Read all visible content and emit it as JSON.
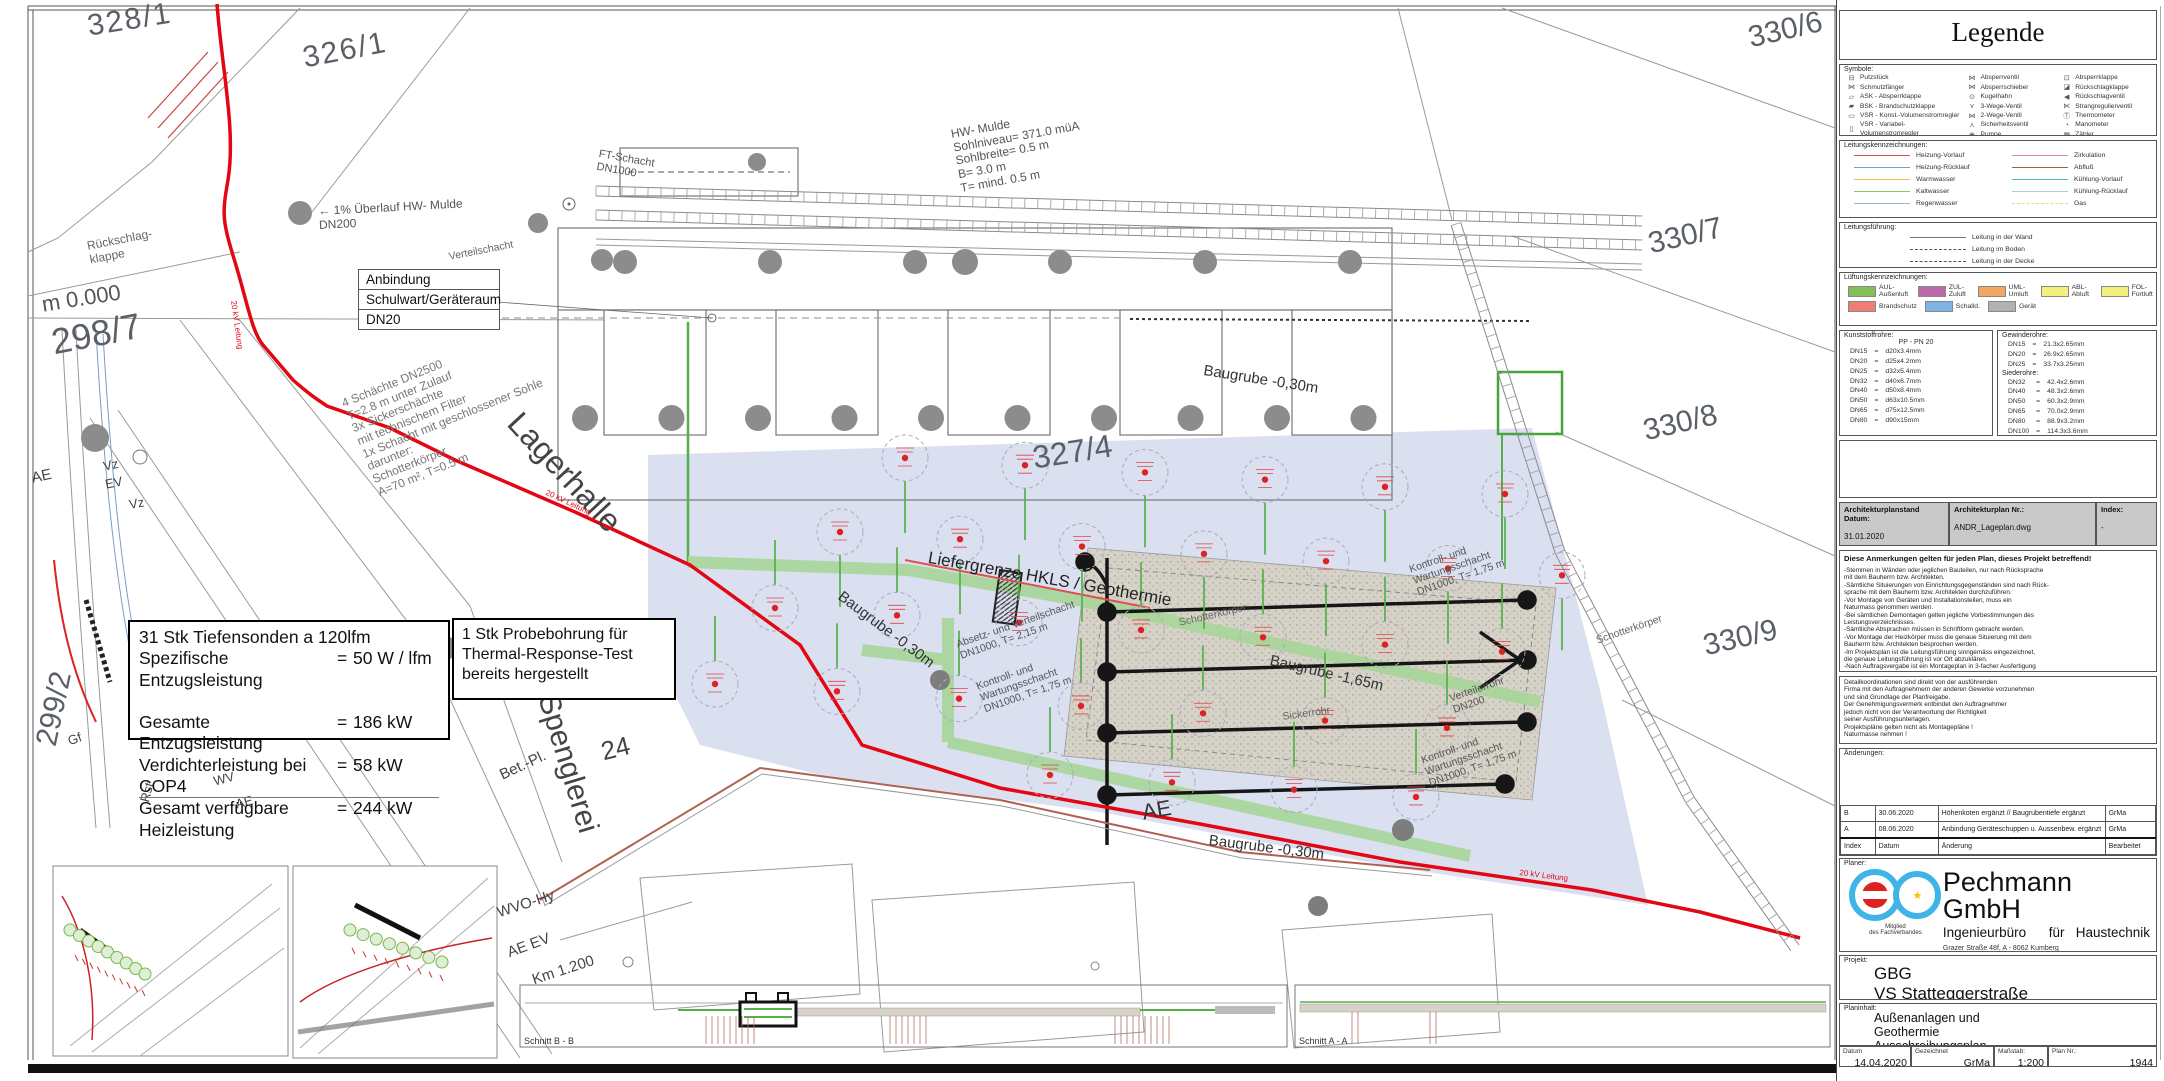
{
  "colors": {
    "red_20kv": "#e30613",
    "green_pipe": "#a9d69b",
    "green_line": "#55b04a",
    "blue_zone": "#ccd3ea",
    "gravel": "#d6d2c8",
    "black_pipe": "#161616"
  },
  "legend": {
    "title": "Legende",
    "symbole_label": "Symbole:",
    "sym_col1": [
      {
        "g": "⊟",
        "label": "Putzstück"
      },
      {
        "g": "⋈",
        "label": "Schmutzfänger"
      },
      {
        "g": "▱",
        "label": "ASK  - Absperrklappe"
      },
      {
        "g": "▰",
        "label": "BSK  - Brandschutzklappe"
      },
      {
        "g": "▭",
        "label": "VSR  - Konst.-Volumenstromregler"
      },
      {
        "g": "▯",
        "label": "VSR  - Variabel-Volumenstromregler"
      }
    ],
    "sym_col2": [
      {
        "g": "⋈",
        "label": "Absperrventil"
      },
      {
        "g": "⋈",
        "label": "Absperrschieber"
      },
      {
        "g": "⊙",
        "label": "Kugelhahn"
      },
      {
        "g": "⋎",
        "label": "3-Wege-Ventil"
      },
      {
        "g": "⋈",
        "label": "2-Wege-Ventil"
      },
      {
        "g": "⋏",
        "label": "Sicherheitsventil"
      },
      {
        "g": "◉",
        "label": "Pumpe"
      }
    ],
    "sym_col3": [
      {
        "g": "⊡",
        "label": "Absperrklappe"
      },
      {
        "g": "◪",
        "label": "Rückschlagklappe"
      },
      {
        "g": "◀",
        "label": "Rückschlagventil"
      },
      {
        "g": "⋉",
        "label": "Strangregulierventil"
      },
      {
        "g": "Ⓣ",
        "label": "Thermometer"
      },
      {
        "g": "◔",
        "label": "Manometer"
      },
      {
        "g": "▦",
        "label": "Zähler"
      }
    ],
    "leitungs_label": "Leitungskennzeichnungen:",
    "leitungen_left": [
      {
        "label": "Heizung-Vorlauf",
        "color": "#d9534f",
        "dash": false
      },
      {
        "label": "Heizung-Rücklauf",
        "color": "#7b9cc4",
        "dash": false
      },
      {
        "label": "Warmwasser",
        "color": "#e8c14d",
        "dash": false
      },
      {
        "label": "Kaltwasser",
        "color": "#8fc470",
        "dash": false
      },
      {
        "label": "Regenwasser",
        "color": "#9ab7d6",
        "dash": false
      }
    ],
    "leitungen_right": [
      {
        "label": "Zirkulation",
        "color": "#e08a8a",
        "dash": false
      },
      {
        "label": "Abfluß",
        "color": "#a65b43",
        "dash": false
      },
      {
        "label": "Kühlung-Vorlauf",
        "color": "#4db6c4",
        "dash": false
      },
      {
        "label": "Kühlung-Rücklauf",
        "color": "#a3d0da",
        "dash": false
      },
      {
        "label": "Gas",
        "color": "#e3de77",
        "dash": true
      }
    ],
    "fuehrung_label": "Leitungsführung:",
    "fuehrung": [
      {
        "label": "Leitung in der Wand",
        "style": "solid"
      },
      {
        "label": "Leitung im Boden",
        "style": "dashed"
      },
      {
        "label": "Leitung in der Decke",
        "style": "dashed"
      }
    ],
    "lueftung_label": "Lüftungskennzeichnungen:",
    "lueftung_row1": [
      {
        "label": "AUL-Außenluft",
        "color": "#84bf5a"
      },
      {
        "label": "ZUL-Zuluft",
        "color": "#bc6aab"
      },
      {
        "label": "UML-Umluft",
        "color": "#f2a65e"
      },
      {
        "label": "ABL-Abluft",
        "color": "#f4f07e"
      },
      {
        "label": "FOL-Fortluft",
        "color": "#f4f07e"
      }
    ],
    "lueftung_row2": [
      {
        "label": "Brandschutz",
        "color": "#ef7d72"
      },
      {
        "label": "Schalld.",
        "color": "#7fb2e5"
      },
      {
        "label": "Gerät",
        "color": "#b2b2b2"
      }
    ],
    "kunststoff_label": "Kunststoffrohre:",
    "kunststoff_header": "PP  -  PN 20",
    "kunststoff_rows": [
      [
        "DN15",
        "=",
        "d20x3.4mm"
      ],
      [
        "DN20",
        "=",
        "d25x4.2mm"
      ],
      [
        "DN25",
        "=",
        "d32x5.4mm"
      ],
      [
        "DN32",
        "=",
        "d40x6.7mm"
      ],
      [
        "DN40",
        "=",
        "d50x8.4mm"
      ],
      [
        "DN50",
        "=",
        "d63x10.5mm"
      ],
      [
        "DN65",
        "=",
        "d75x12.5mm"
      ],
      [
        "DN80",
        "=",
        "d90x15mm"
      ]
    ],
    "gewinde_label": "Gewinderohre:",
    "gewinde_rows": [
      [
        "DN15",
        "=",
        "21.3x2.65mm"
      ],
      [
        "DN20",
        "=",
        "26.9x2.65mm"
      ],
      [
        "DN25",
        "=",
        "33.7x3.25mm"
      ]
    ],
    "siede_label": "Siederohre:",
    "siede_rows": [
      [
        "DN32",
        "=",
        "42.4x2.6mm"
      ],
      [
        "DN40",
        "=",
        "48.3x2.6mm"
      ],
      [
        "DN50",
        "=",
        "60.3x2.9mm"
      ],
      [
        "DN65",
        "=",
        "70.0x2.9mm"
      ],
      [
        "DN80",
        "=",
        "88.9x3.2mm"
      ],
      [
        "DN100",
        "=",
        "114.3x3.6mm"
      ]
    ]
  },
  "plan_meta": {
    "stand_label": "Architekturplanstand Datum:",
    "stand": "31.01.2020",
    "nr_label": "Architekturplan Nr.:",
    "nr": "ANDR_Lageplan.dwg",
    "index_label": "Index:",
    "index": "-"
  },
  "notes": {
    "heading": "Diese Anmerkungen gelten für jeden Plan, dieses Projekt betreffend!",
    "body": "-Stemmen in Wänden oder jeglichen Bauteilen, nur nach Rücksprache\n mit dem Bauherrn bzw. Architekten.\n-Sämtliche Situierungen von Einrichtungsgegenständen sind nach Rück-\n sprache mit dem Bauherrn bzw. Architekten durchzuführen.\n-Vor Montage von Geräten und Installationsteilen, muss ein\n Naturmass genommen werden.\n-Bei sämtlichen Demontagen gelten jegliche Vorbestimmungen des\n Leistungsverzeichnisses.\n-Sämtliche Absprachen müssen in Schriftform gebracht werden.\n-Vor Montage der Heizkörper muss die genaue Situierung mit dem\n Bauherrn bzw. Architekten besprochen werden.\n-Im Projektsplan ist die Leitungsführung sinngemäss eingezeichnet,\n die genaue Leitungsführung ist vor Ort abzuklären.\n-Nach Auftragsvergabe ist ein Montageplan in 3-facher Ausfertigung\n zu zeichnen und dem Technischen Büro zur Freigabe vorzulegen."
  },
  "detail_note": "Detailkoordinationen sind direkt von der ausführenden\nFirma mit den Auftragnehmern der anderen Gewerke vorzunehmen\nund sind Grundlage der Planfreigabe.\nDer Genehmigungsvermerk entbindet den Auftragnehmer\njedoch nicht von der Verantwortung der Richtigkeit\nseiner Ausführungsunterlagen.\nProjektspläne gelten nicht als Montagepläne !\nNaturmasse nehmen !",
  "changes": {
    "label": "Änderungen:",
    "rows": [
      [
        "B",
        "30.06.2020",
        "Höhenkoten ergänzt // Baugrubentiefe ergänzt",
        "GrMa"
      ],
      [
        "A",
        "08.06.2020",
        "Anbindung Geräteschuppen u. Aussenbew. ergänzt",
        "GrMa"
      ],
      [
        "Index",
        "Datum",
        "Änderung",
        "Bearbeitet"
      ]
    ]
  },
  "planer": {
    "label": "Planer:",
    "company": "Pechmann GmbH",
    "subtitle": "Ingenieurbüro      für   Haustechnik",
    "address": "Grazer Straße 48f, A - 8062 Kumberg\nTel.: 03132/5485 Fax: 03132/5485-16\ne-mail: office@tb-pechmann.at",
    "member": "Mitglied\ndes Fachverbandes"
  },
  "projekt": {
    "label": "Projekt:",
    "text": "GBG\nVS Statteggerstraße"
  },
  "planinhalt": {
    "label": "Planinhalt:",
    "text": "Außenanlagen und\nGeothermie\nAusschreibungsplan"
  },
  "footer": {
    "datum_label": "Datum",
    "datum": "14.04.2020",
    "gez_label": "Gezeichnet",
    "gez": "GrMa",
    "mass_label": "Maßstab:",
    "mass": "1:200",
    "plan_label": "Plan Nr.:",
    "plan": "1944"
  },
  "map": {
    "parcels": {
      "p328_1": "328/1",
      "p326_1": "326/1",
      "p330_6": "330/6",
      "p330_7": "330/7",
      "p330_8": "330/8",
      "p330_9": "330/9",
      "p327_4": "327/4",
      "p298_7": "298/7",
      "p299_2": "299/2"
    },
    "labels": {
      "lagerhalle": "Lagerhalle",
      "spenglerei": "Spenglerei",
      "nr24": "24",
      "betpl": "Bet.-Pl.",
      "wvohy": "WVO-Hy",
      "aeev": "AE EV",
      "km": "Km 1.200",
      "m0": "m 0.000",
      "ae": "AE",
      "vz": "Vz",
      "ev": "EV",
      "gf": "Gf",
      "rst": "Rst",
      "wv": "WV",
      "rueckschlag": "Rückschlag-\nklappe",
      "hw_mulde": "HW- Mulde\nSohlniveau= 371.0 müA\nSohlbreite= 0.5 m\nB= 3.0 m\nT= mind. 0.5 m",
      "ueberlauf": "← 1% Überlauf HW- Mulde\n         DN200",
      "ft_schacht": "FT-Schacht\nDN1000",
      "schaechte": "4 Schächte DN2500\nT=2.8 m unter Zulauf\n3x Sickerschächte\nmit technischem Filter\n1x Schacht mit geschlossener Sohle\ndarunter:\nSchotterkörper\nA=70 m², T=0.5 m",
      "liefergrenze": "Liefergrenze HKLS / Geothermie",
      "baugrube30": "Baugrube -0,30m",
      "baugrube165": "Baugrube -1,65m",
      "absetz": "Absetz- und Verteilschacht\nDN1000, T= 2,15 m",
      "kontroll": "Kontroll- und\nWartungsschacht\nDN1000, T= 1,75 m",
      "verteilerrohr": "Verteilerrohr\nDN200",
      "schotter": "Schotterkörper",
      "sickerrohr": "Sickerrohr",
      "verteilschacht": "Verteilschacht",
      "kv": "20 kV Leitung",
      "schnitt_b": "Schnitt B - B",
      "schnitt_a": "Schnitt A - A"
    },
    "box_sonden": {
      "l1": "31 Stk Tiefensonden a 120lfm",
      "rows": [
        [
          "Spezifische Entzugsleistung",
          "=",
          "50 W / lfm"
        ],
        [
          "",
          "",
          ""
        ],
        [
          "Gesamte Entzugsleistung",
          "=",
          "186 kW"
        ],
        [
          "Verdichterleistung bei COP4",
          "=",
          "58 kW"
        ],
        [
          "Gesamt verfügbare Heizleistung",
          "=",
          "244 kW"
        ]
      ]
    },
    "box_probe": "1 Stk Probebohrung für\nThermal-Response-Test\nbereits hergestellt",
    "box_anbindung": [
      "Anbindung",
      "Schulwart/Geräteraum",
      "DN20"
    ]
  }
}
